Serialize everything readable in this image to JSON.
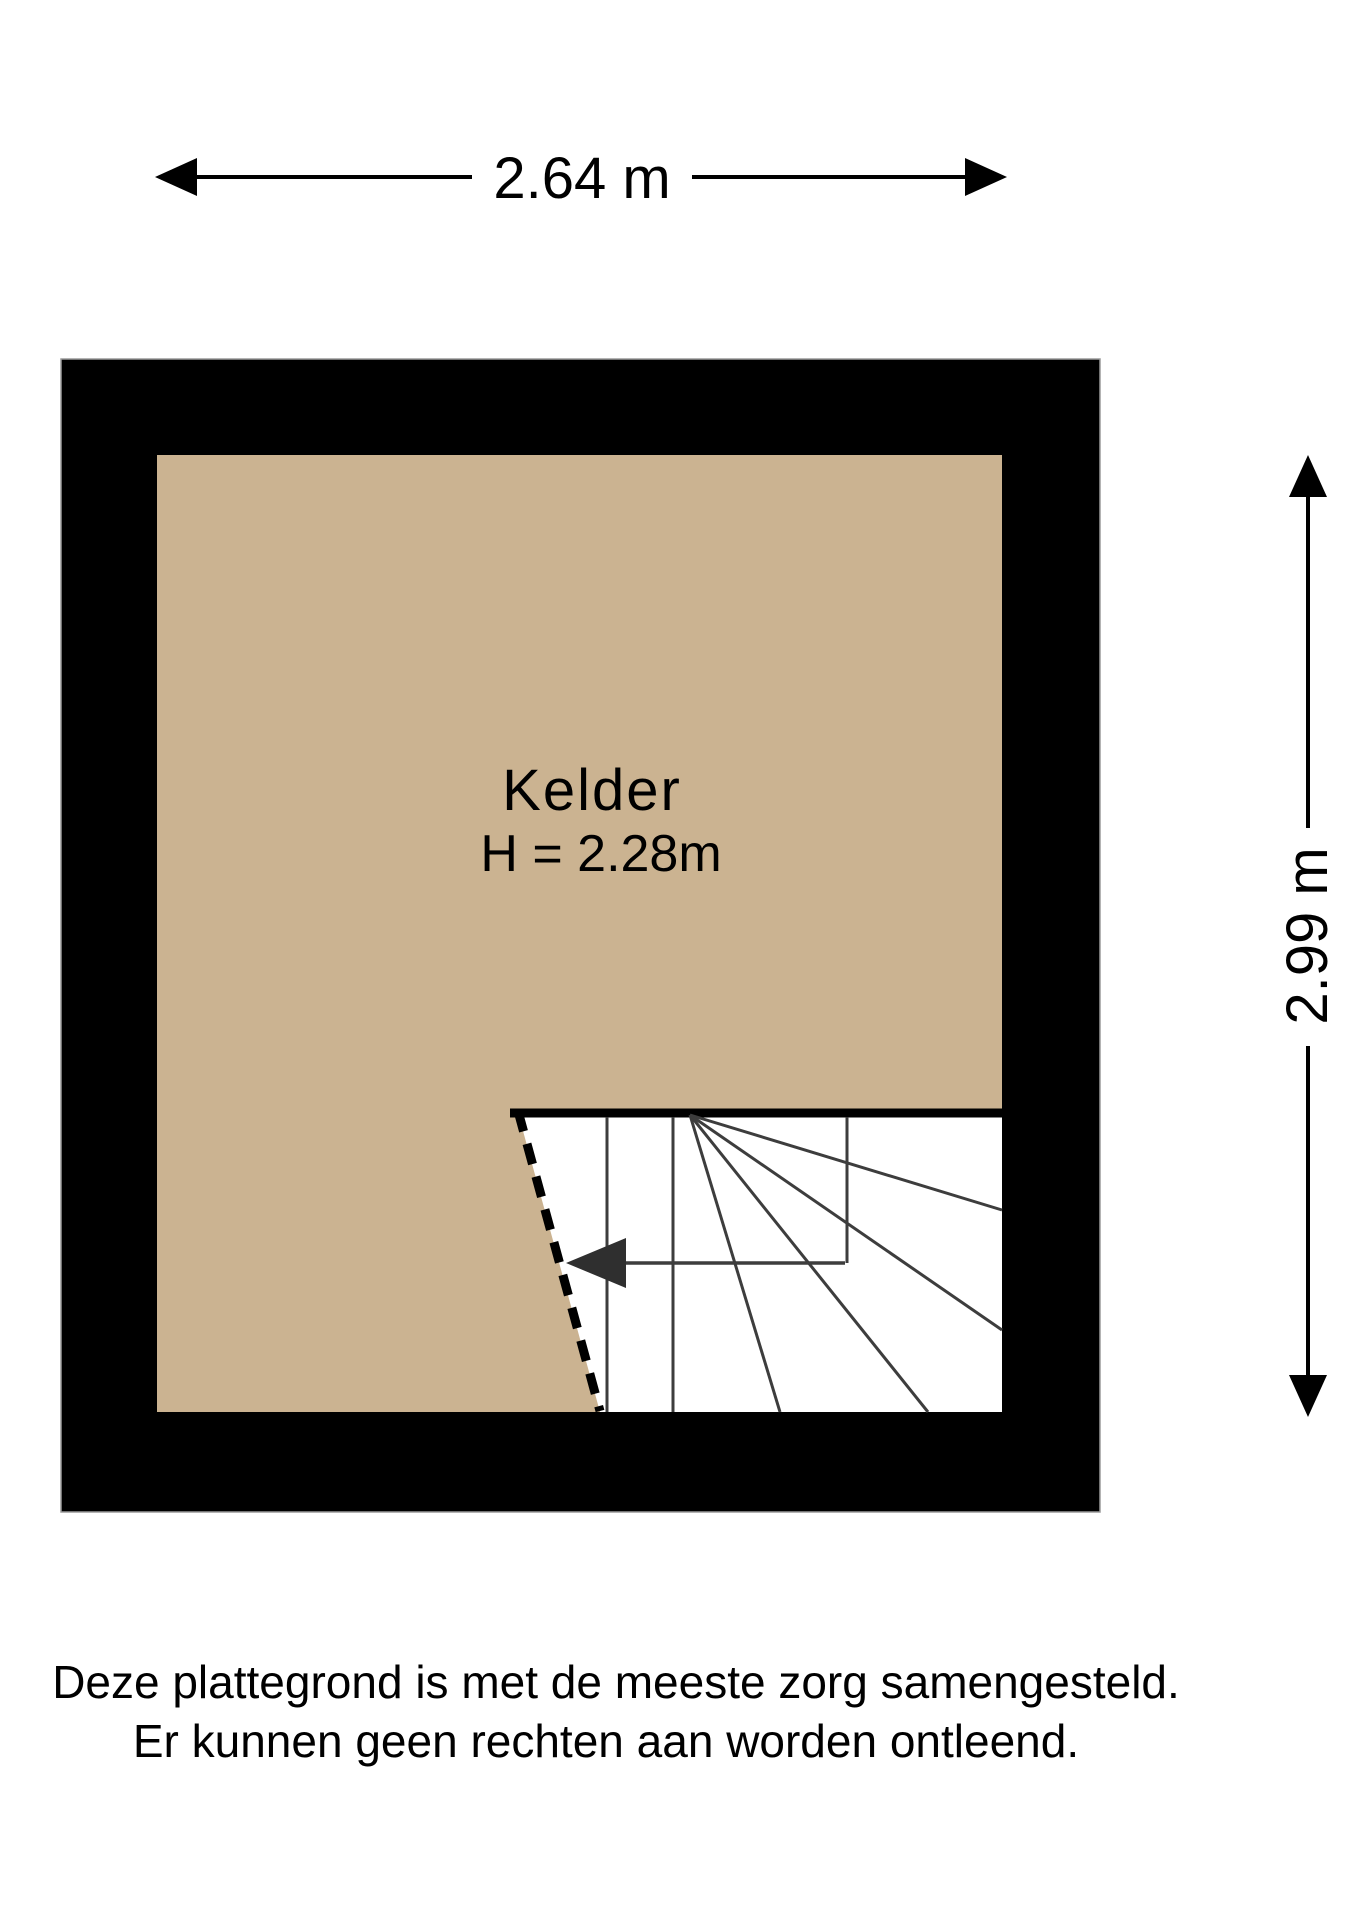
{
  "floor_plan": {
    "room": {
      "name": "Kelder",
      "ceiling_height_label": "H = 2.28m"
    },
    "dimensions": {
      "width": {
        "label": "2.64 m",
        "value_m": 2.64
      },
      "height": {
        "label": "2.99 m",
        "value_m": 2.99
      }
    },
    "colors": {
      "floor_fill": "#CBB391",
      "wall": "#000000",
      "stair_lines": "#3d3d3d"
    }
  },
  "disclaimer": {
    "line1": "Deze plattegrond is met de meeste zorg samengesteld.",
    "line2": "Er kunnen geen rechten aan worden ontleend."
  }
}
